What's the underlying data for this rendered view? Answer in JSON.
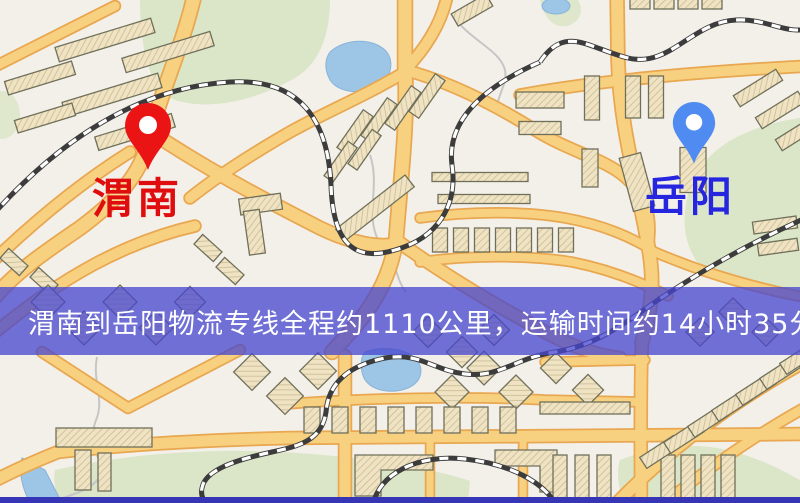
{
  "map": {
    "markers": [
      {
        "id": "weinan",
        "label": "渭南",
        "color": "#EB1414",
        "label_color": "#DF0D0D",
        "icon": "map-pin-icon"
      },
      {
        "id": "yueyang",
        "label": "岳阳",
        "color": "#4F8BF0",
        "label_color": "#2626DF",
        "icon": "map-pin-icon"
      }
    ],
    "banner": {
      "text": "渭南到岳阳物流专线全程约1110公里，运输时间约14小时35分钟.",
      "bg": "rgba(70,70,206,0.76)",
      "text_color": "#FFFFFF"
    },
    "bottom_strip_color": "#3535B5",
    "palette": {
      "land": "#F3F0EA",
      "park": "#DBE6C8",
      "water": "#9CC5E6",
      "road_fill": "#F8D180",
      "road_casing": "#E8A750",
      "building": "#EFE3C3",
      "building_outline": "#70705A",
      "railway_dark": "#3C3C3C",
      "railway_light": "#FFFFFF"
    }
  }
}
